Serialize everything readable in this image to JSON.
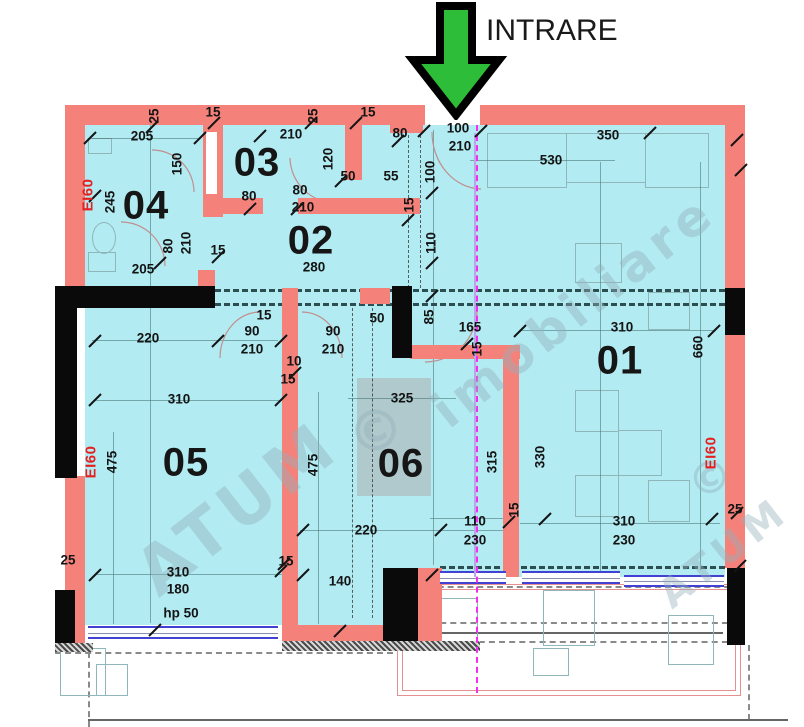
{
  "entrance": {
    "label": "INTRARE"
  },
  "colors": {
    "room_fill": "#b2ebf2",
    "wall_red": "#f5827a",
    "wall_black": "#0a0a0a",
    "fire_label_red": "#e42120",
    "window_blue": "#4242d2",
    "section_line_magenta": "#f62df0",
    "arrow_green": "#2ebd38"
  },
  "rooms": [
    {
      "number": "01",
      "x": 620,
      "y": 361
    },
    {
      "number": "02",
      "x": 311,
      "y": 241
    },
    {
      "number": "03",
      "x": 257,
      "y": 163
    },
    {
      "number": "04",
      "x": 146,
      "y": 206
    },
    {
      "number": "05",
      "x": 186,
      "y": 463
    },
    {
      "number": "06",
      "x": 401,
      "y": 464
    }
  ],
  "fire_ratings": [
    {
      "label": "EI60",
      "x": 88,
      "y": 195
    },
    {
      "label": "EI60",
      "x": 91,
      "y": 462
    },
    {
      "label": "EI60",
      "x": 711,
      "y": 453
    }
  ],
  "dimensions": [
    {
      "text": "205",
      "x": 142,
      "y": 136
    },
    {
      "text": "25",
      "x": 154,
      "y": 116,
      "rot": 1
    },
    {
      "text": "15",
      "x": 213,
      "y": 112
    },
    {
      "text": "210",
      "x": 291,
      "y": 134
    },
    {
      "text": "25",
      "x": 313,
      "y": 116,
      "rot": 1
    },
    {
      "text": "15",
      "x": 368,
      "y": 112
    },
    {
      "text": "80",
      "x": 400,
      "y": 133
    },
    {
      "text": "100",
      "x": 458,
      "y": 128
    },
    {
      "text": "210",
      "x": 460,
      "y": 146
    },
    {
      "text": "350",
      "x": 608,
      "y": 135
    },
    {
      "text": "530",
      "x": 551,
      "y": 160
    },
    {
      "text": "245",
      "x": 110,
      "y": 202,
      "rot": 1
    },
    {
      "text": "150",
      "x": 177,
      "y": 164,
      "rot": 1
    },
    {
      "text": "80",
      "x": 249,
      "y": 196
    },
    {
      "text": "80",
      "x": 300,
      "y": 190
    },
    {
      "text": "210",
      "x": 303,
      "y": 207
    },
    {
      "text": "120",
      "x": 328,
      "y": 159,
      "rot": 1
    },
    {
      "text": "50",
      "x": 348,
      "y": 176
    },
    {
      "text": "55",
      "x": 391,
      "y": 176
    },
    {
      "text": "15",
      "x": 218,
      "y": 250
    },
    {
      "text": "80",
      "x": 168,
      "y": 246,
      "rot": 1
    },
    {
      "text": "210",
      "x": 186,
      "y": 243,
      "rot": 1
    },
    {
      "text": "205",
      "x": 143,
      "y": 269
    },
    {
      "text": "15",
      "x": 409,
      "y": 205,
      "rot": 1
    },
    {
      "text": "100",
      "x": 430,
      "y": 172,
      "rot": 1
    },
    {
      "text": "110",
      "x": 431,
      "y": 243,
      "rot": 1
    },
    {
      "text": "280",
      "x": 314,
      "y": 267
    },
    {
      "text": "50",
      "x": 377,
      "y": 318
    },
    {
      "text": "85",
      "x": 429,
      "y": 317,
      "rot": 1
    },
    {
      "text": "165",
      "x": 470,
      "y": 327
    },
    {
      "text": "15",
      "x": 477,
      "y": 349,
      "rot": 1
    },
    {
      "text": "310",
      "x": 622,
      "y": 327
    },
    {
      "text": "660",
      "x": 698,
      "y": 347,
      "rot": 1
    },
    {
      "text": "220",
      "x": 148,
      "y": 338
    },
    {
      "text": "90",
      "x": 252,
      "y": 331
    },
    {
      "text": "210",
      "x": 252,
      "y": 349
    },
    {
      "text": "15",
      "x": 264,
      "y": 315
    },
    {
      "text": "90",
      "x": 333,
      "y": 331
    },
    {
      "text": "210",
      "x": 333,
      "y": 349
    },
    {
      "text": "10",
      "x": 294,
      "y": 361
    },
    {
      "text": "15",
      "x": 288,
      "y": 379
    },
    {
      "text": "310",
      "x": 179,
      "y": 399
    },
    {
      "text": "475",
      "x": 112,
      "y": 462,
      "rot": 1
    },
    {
      "text": "475",
      "x": 313,
      "y": 465,
      "rot": 1
    },
    {
      "text": "325",
      "x": 402,
      "y": 398
    },
    {
      "text": "315",
      "x": 492,
      "y": 462,
      "rot": 1
    },
    {
      "text": "330",
      "x": 540,
      "y": 457,
      "rot": 1
    },
    {
      "text": "220",
      "x": 366,
      "y": 530
    },
    {
      "text": "110",
      "x": 475,
      "y": 521
    },
    {
      "text": "230",
      "x": 475,
      "y": 540
    },
    {
      "text": "15",
      "x": 514,
      "y": 510,
      "rot": 1
    },
    {
      "text": "310",
      "x": 624,
      "y": 521
    },
    {
      "text": "230",
      "x": 624,
      "y": 540
    },
    {
      "text": "25",
      "x": 735,
      "y": 509
    },
    {
      "text": "25",
      "x": 68,
      "y": 560
    },
    {
      "text": "15",
      "x": 286,
      "y": 561
    },
    {
      "text": "140",
      "x": 340,
      "y": 581
    },
    {
      "text": "310",
      "x": 178,
      "y": 572
    },
    {
      "text": "180",
      "x": 178,
      "y": 589
    },
    {
      "text": "hp 50",
      "x": 181,
      "y": 613
    }
  ],
  "watermark": [
    {
      "text": "ATUM",
      "x": 120,
      "y": 470,
      "rot": -38,
      "size": 66
    },
    {
      "text": "©",
      "x": 348,
      "y": 398,
      "rot": -20,
      "size": 56
    },
    {
      "text": "imobiliare",
      "x": 402,
      "y": 282,
      "rot": -38,
      "size": 50
    },
    {
      "text": "ATUM",
      "x": 648,
      "y": 530,
      "rot": -38,
      "size": 40
    },
    {
      "text": "©",
      "x": 688,
      "y": 452,
      "rot": -20,
      "size": 44
    }
  ]
}
